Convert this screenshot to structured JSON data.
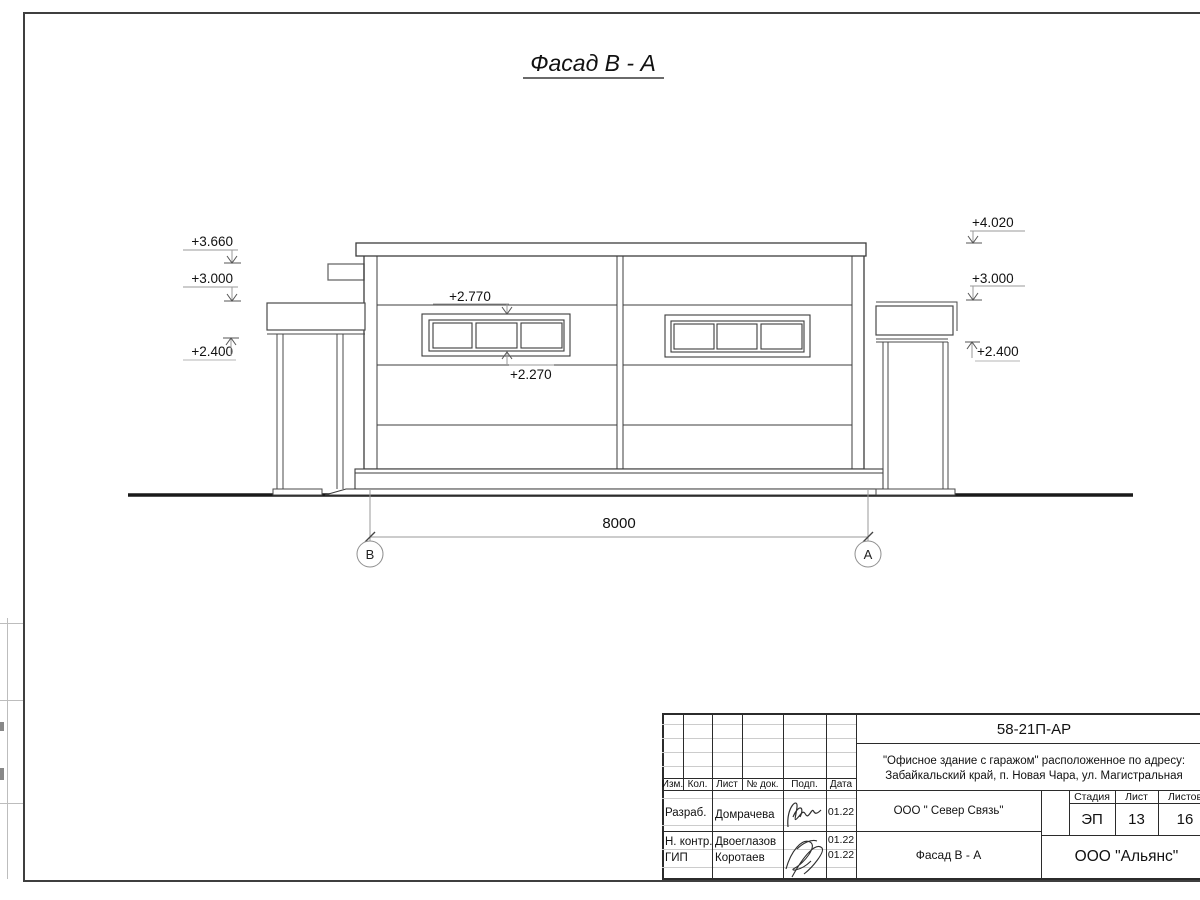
{
  "drawing": {
    "title": "Фасад В - А",
    "dimension_total": "8000",
    "axis_left": "В",
    "axis_right": "А",
    "elevation_marks": {
      "left": [
        "+3.660",
        "+3.000",
        "+2.400"
      ],
      "right": [
        "+4.020",
        "+3.000",
        "+2.400"
      ],
      "window_top": "+2.770",
      "window_bottom": "+2.270"
    }
  },
  "title_block": {
    "doc_number": "58-21П-АР",
    "project_address_line1": "\"Офисное здание с гаражом\" расположенное по адресу:",
    "project_address_line2": "Забайкальский край, п. Новая Чара, ул. Магистральная",
    "header_columns": [
      "Изм.",
      "Кол.",
      "Лист",
      "№ док.",
      "Подп.",
      "Дата"
    ],
    "signature_rows": [
      {
        "role": "Разраб.",
        "name": "Домрачева",
        "date": "01.22"
      },
      {
        "role": "Н. контр.",
        "name": "Двоеглазов",
        "date": "01.22"
      },
      {
        "role": "ГИП",
        "name": "Коротаев",
        "date": "01.22"
      }
    ],
    "customer": "ООО \" Север Связь\"",
    "sheet_title": "Фасад В - А",
    "stage_label": "Стадия",
    "sheet_label": "Лист",
    "sheets_label": "Листов",
    "stage": "ЭП",
    "sheet_number": "13",
    "sheets_total": "16",
    "designer_org": "ООО \"Альянс\""
  }
}
